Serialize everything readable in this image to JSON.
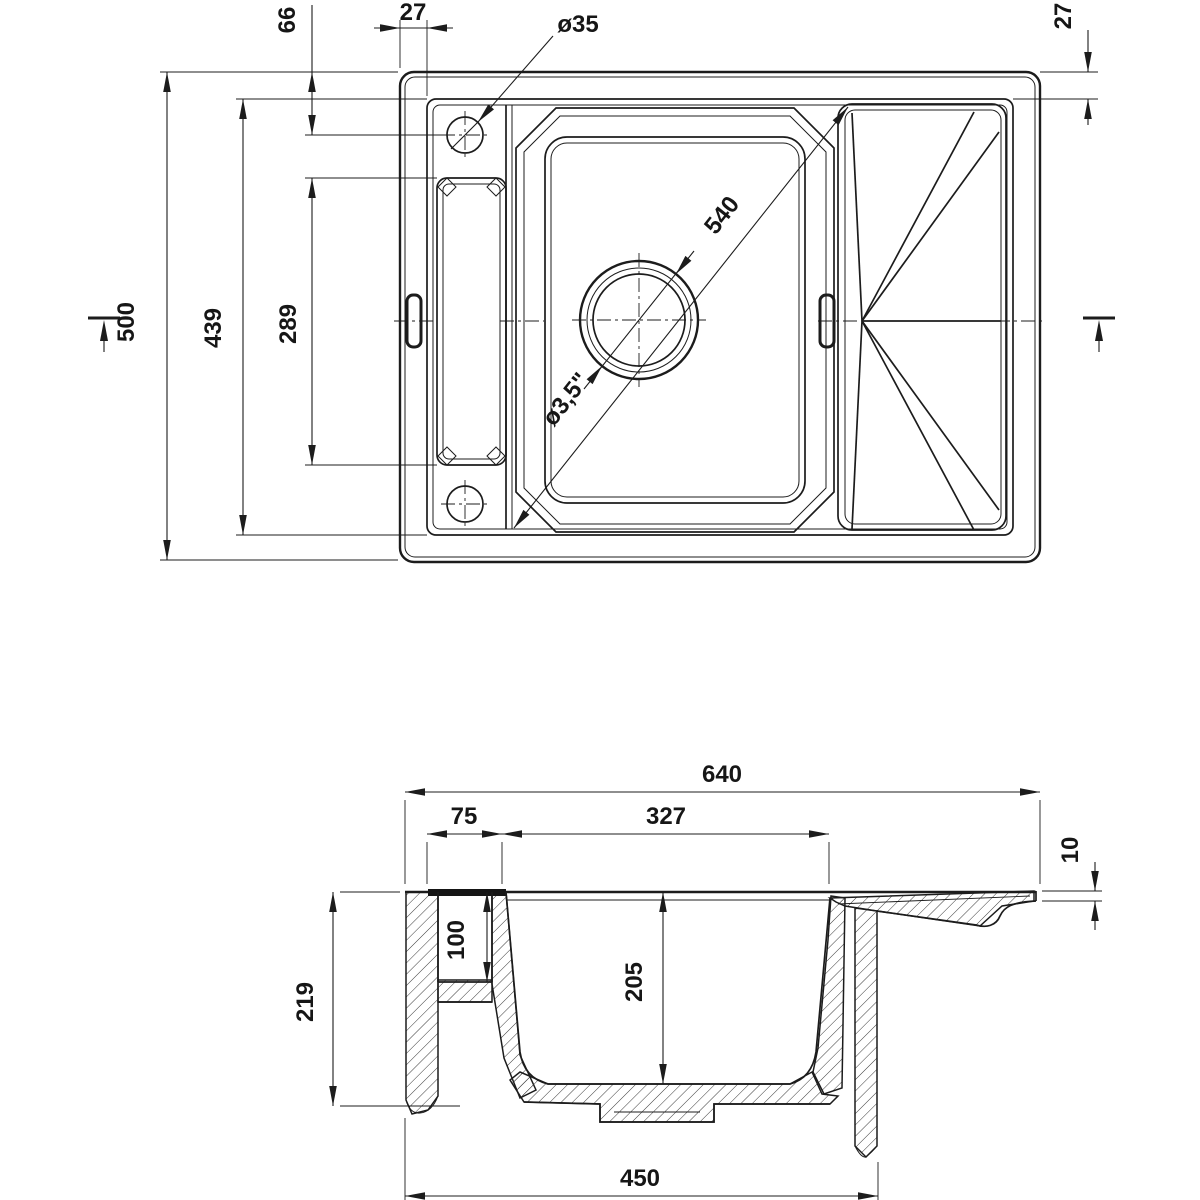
{
  "drawing": {
    "kind": "sink-technical-drawing",
    "views": {
      "plan": {
        "dims": {
          "hole_offset_top": "66",
          "rim_left_width": "27",
          "hole_diameter": "ø35",
          "rim_top_right_width": "27",
          "overall_height": "500",
          "inner_rim_height": "439",
          "recess_height": "289",
          "bowl_diagonal": "540",
          "drain_diameter": "ø3,5\""
        }
      },
      "section": {
        "dims": {
          "overall_width": "640",
          "pocket_width": "75",
          "bowl_top_width": "327",
          "edge_thickness": "10",
          "overall_depth": "219",
          "pocket_depth": "100",
          "bowl_depth": "205",
          "bottom_width": "450"
        }
      }
    }
  }
}
